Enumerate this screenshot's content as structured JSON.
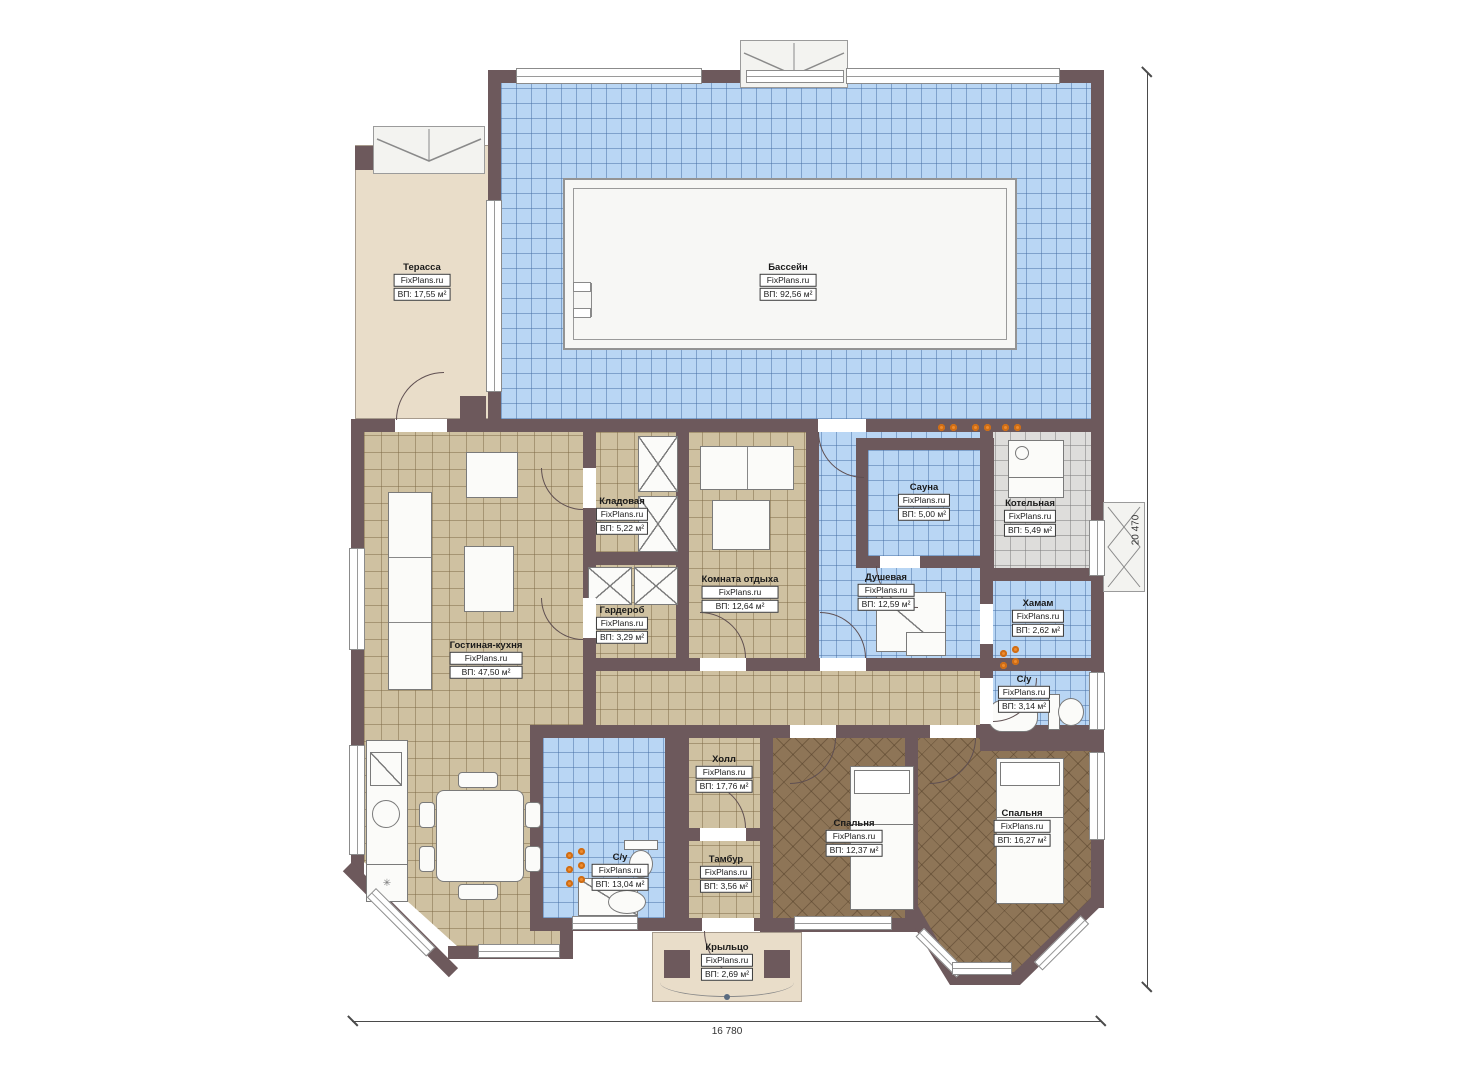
{
  "brand": "FixPlans.ru",
  "dims": {
    "bottom": "16 780",
    "right": "20 470"
  },
  "colors": {
    "wall": "#6d595c",
    "pool_tile": "#b9d6f4",
    "living_tile": "#cfc1a1",
    "bedroom_tile": "#8e7557",
    "boiler_tile": "#dedddb",
    "terrace": "#e9ddc9",
    "heat_marker": "#ef8c2e"
  },
  "rooms": [
    {
      "name": "Терасса",
      "area": "ВП: 17,55 м²"
    },
    {
      "name": "Бассейн",
      "area": "ВП: 92,56 м²"
    },
    {
      "name": "Кладовая",
      "area": "ВП: 5,22 м²"
    },
    {
      "name": "Гардероб",
      "area": "ВП: 3,29 м²"
    },
    {
      "name": "Комната отдыха",
      "area": "ВП: 12,64 м²"
    },
    {
      "name": "Сауна",
      "area": "ВП: 5,00 м²"
    },
    {
      "name": "Котельная",
      "area": "ВП: 5,49 м²"
    },
    {
      "name": "Душевая",
      "area": "ВП: 12,59 м²"
    },
    {
      "name": "Хамам",
      "area": "ВП: 2,62 м²"
    },
    {
      "name": "Гостиная-кухня",
      "area": "ВП: 47,50 м²"
    },
    {
      "name": "С/у",
      "area": "ВП: 3,14 м²"
    },
    {
      "name": "Холл",
      "area": "ВП: 17,76 м²"
    },
    {
      "name": "С/у",
      "area": "ВП: 13,04 м²"
    },
    {
      "name": "Тамбур",
      "area": "ВП: 3,56 м²"
    },
    {
      "name": "Спальня",
      "area": "ВП: 12,37 м²"
    },
    {
      "name": "Спальня",
      "area": "ВП: 16,27 м²"
    },
    {
      "name": "Крыльцо",
      "area": "ВП: 2,69 м²"
    }
  ]
}
